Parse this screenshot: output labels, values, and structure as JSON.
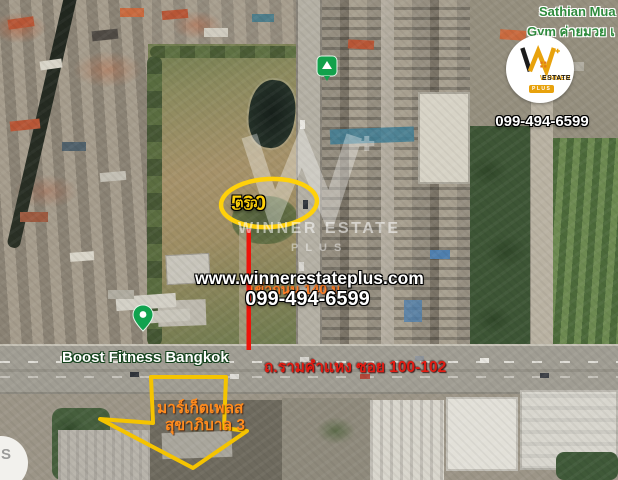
{
  "branding": {
    "logo": {
      "brand_word1": "WINNER",
      "brand_word2": "ESTATE",
      "plus_label": "PLUS"
    },
    "watermark": {
      "brand": "WINNER ESTATE",
      "plus_label": "PLUS"
    },
    "website": "www.winnerestateplus.com",
    "phone_center": "099-494-6599",
    "phone_top": "099-494-6599"
  },
  "map_labels": {
    "gym_line1": "Sathian Mua",
    "gym_line2": "Gym ค่ายมวย เ",
    "fitness": "Boost Fitness Bangkok",
    "road": "ถ.รามคำแหง ซอย 100-102",
    "partial_s": "S"
  },
  "annotations": {
    "area_value": "590",
    "area_unit": "ตรว",
    "distance_note": "เข้าถนน 140 ม",
    "arrow_line1": "มาร์เก็ตเพลส",
    "arrow_line2": "สุขาภิบาล 3"
  },
  "colors": {
    "accent_yellow": "#ffd10a",
    "accent_red": "#ed1409",
    "accent_orange": "#ff8b1e",
    "road_label_red": "#e31b12",
    "pin_green": "#12a14b",
    "brand_gold": "#e8a20c"
  }
}
